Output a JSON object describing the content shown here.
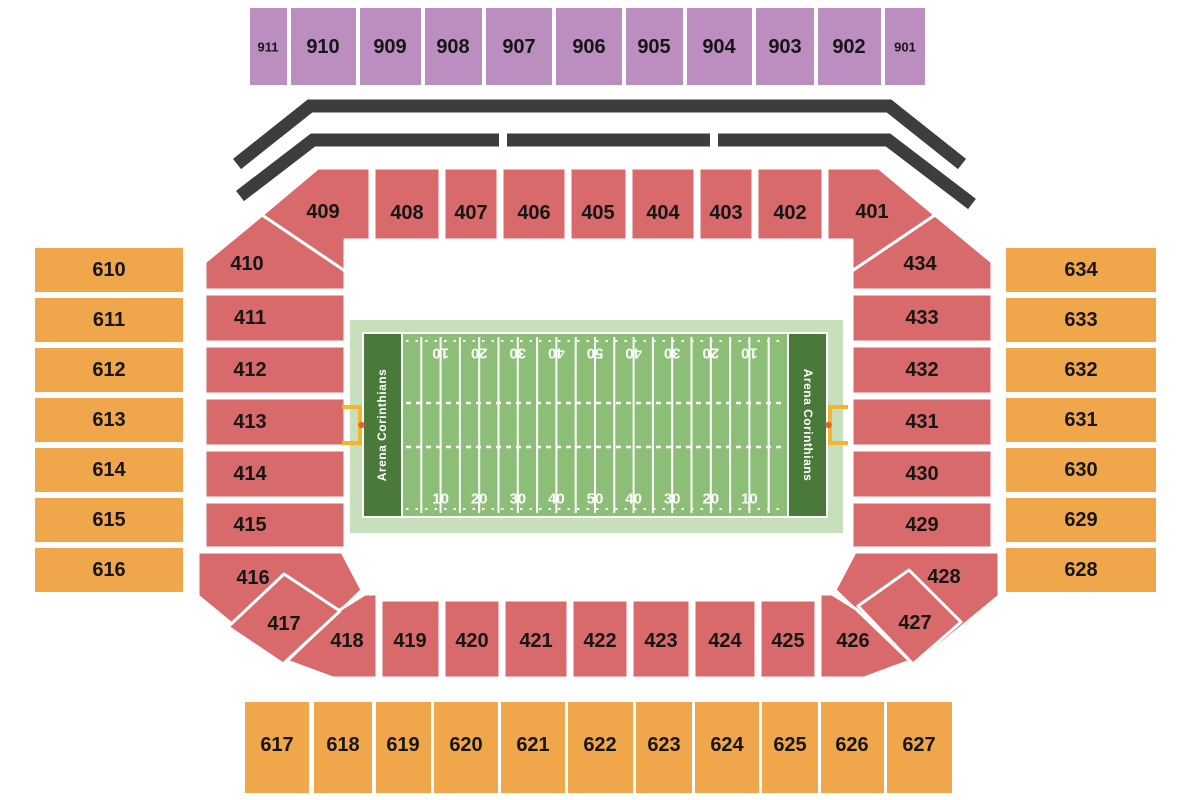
{
  "title": "Stadium seating chart with football field",
  "sections": {
    "upper_900": [
      "911",
      "910",
      "909",
      "908",
      "907",
      "906",
      "905",
      "904",
      "903",
      "902",
      "901"
    ],
    "ring_400_top": [
      "409",
      "408",
      "407",
      "406",
      "405",
      "404",
      "403",
      "402",
      "401"
    ],
    "ring_400_left": [
      "410",
      "411",
      "412",
      "413",
      "414",
      "415",
      "416"
    ],
    "ring_400_right": [
      "434",
      "433",
      "432",
      "431",
      "430",
      "429",
      "428"
    ],
    "ring_400_bottom": [
      "418",
      "419",
      "420",
      "421",
      "422",
      "423",
      "424",
      "425",
      "426"
    ],
    "corner_diamonds": [
      "417",
      "427"
    ],
    "side_600_left": [
      "610",
      "611",
      "612",
      "613",
      "614",
      "615",
      "616"
    ],
    "side_600_right": [
      "634",
      "633",
      "632",
      "631",
      "630",
      "629",
      "628"
    ],
    "lower_600": [
      "617",
      "618",
      "619",
      "620",
      "621",
      "622",
      "623",
      "624",
      "625",
      "626",
      "627"
    ]
  },
  "field": {
    "endzone_left_text": "Arena Corinthians",
    "endzone_right_text": "Arena Corinthians",
    "yard_numbers_top": [
      "10",
      "20",
      "30",
      "40",
      "50",
      "40",
      "30",
      "20",
      "10"
    ],
    "yard_numbers_bottom": [
      "10",
      "20",
      "30",
      "40",
      "50",
      "40",
      "30",
      "20",
      "10"
    ]
  },
  "colors": {
    "purple_900": "#bc8ec0",
    "red_400": "#d96a6c",
    "orange_600": "#f0a64b",
    "canopy_gray": "#3d3d3d",
    "field_apron_green": "#c8dfbc",
    "turf_green": "#8cbe77",
    "endzone_green": "#4a7a3a",
    "goalpost_yellow": "#f2b52d",
    "goalpost_dot_orange": "#e2622e",
    "line_white": "#ffffff",
    "label_black": "#161616"
  }
}
